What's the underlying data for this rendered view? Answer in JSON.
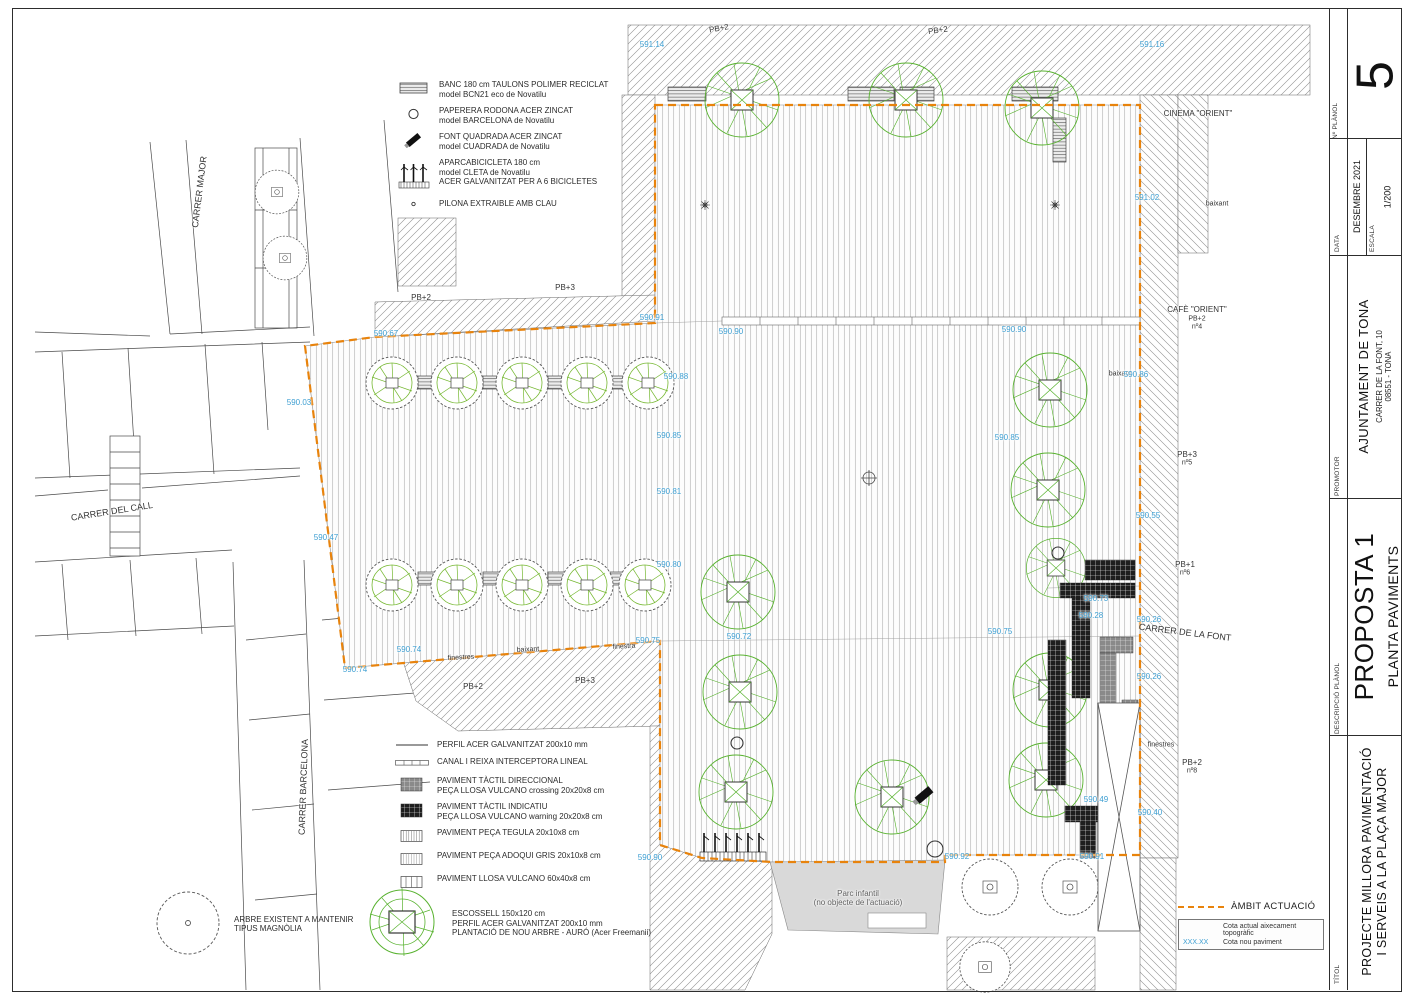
{
  "sheet": {
    "number": "5",
    "number_label": "Nº PLÀNOL",
    "date_label": "DATA",
    "date": "DESEMBRE 2021",
    "scale_label": "ESCALA",
    "scale": "1/200",
    "promoter_label": "PROMOTOR",
    "promoter_name": "AJUNTAMENT DE TONA",
    "promoter_address1": "CARRER DE LA FONT, 10",
    "promoter_address2": "08551  -  TONA",
    "description_label": "DESCRIPCIÓ PLÀNOL",
    "proposal": "PROPOSTA 1",
    "plan_name": "PLANTA PAVIMENTS",
    "title_label": "TÍTOL",
    "project_title1": "PROJECTE MILLORA PAVIMENTACIÓ",
    "project_title2": "I SERVEIS A LA PLAÇA MAJOR"
  },
  "legend_furniture": [
    {
      "symbol": "bench",
      "lines": [
        "BANC 180 cm TAULONS POLIMER RECICLAT",
        "model BCN21 eco de Novatilu"
      ]
    },
    {
      "symbol": "bin",
      "lines": [
        "PAPERERA RODONA ACER ZINCAT",
        "model BARCELONA de Novatilu"
      ]
    },
    {
      "symbol": "fountain",
      "lines": [
        "FONT QUADRADA ACER ZINCAT",
        "model CUADRADA de Novatilu"
      ]
    },
    {
      "symbol": "bike-rack",
      "lines": [
        "APARCABICICLETA 180 cm",
        "model CLETA de Novatilu",
        "ACER GALVANITZAT PER A 6 BICICLETES"
      ]
    },
    {
      "symbol": "bollard",
      "lines": [
        "PILONA EXTRAIBLE AMB CLAU"
      ]
    }
  ],
  "legend_paving": [
    {
      "symbol": "steel-line",
      "lines": [
        "PERFIL ACER GALVANITZAT 200x10 mm"
      ]
    },
    {
      "symbol": "channel",
      "lines": [
        "CANAL I REIXA INTERCEPTORA LINEAL"
      ]
    },
    {
      "symbol": "tactile-directional",
      "lines": [
        "PAVIMENT TÀCTIL DIRECCIONAL",
        "PEÇA LLOSA VULCANO crossing 20x20x8 cm"
      ]
    },
    {
      "symbol": "tactile-warning",
      "lines": [
        "PAVIMENT TÀCTIL INDICATIU",
        "PEÇA LLOSA VULCANO warning 20x20x8 cm"
      ]
    },
    {
      "symbol": "tegula",
      "lines": [
        "PAVIMENT PEÇA TEGULA 20x10x8 cm"
      ]
    },
    {
      "symbol": "adoqui",
      "lines": [
        "PAVIMENT PEÇA ADOQUI GRIS 20x10x8 cm"
      ]
    },
    {
      "symbol": "llosa",
      "lines": [
        "PAVIMENT LLOSA VULCANO 60x40x8 cm"
      ]
    }
  ],
  "legend_trees": [
    {
      "symbol": "existing-tree",
      "lines": [
        "ARBRE EXISTENT A MANTENIR",
        "TIPUS MAGNÒLIA"
      ]
    },
    {
      "symbol": "new-tree",
      "lines": [
        "ESCOSSELL 150x120 cm",
        "PERFIL ACER GALVANITZAT 200x10 mm",
        "PLANTACIÓ DE NOU ARBRE - AURÓ (Acer Freemanii)"
      ]
    }
  ],
  "scope": {
    "label": "ÀMBIT ACTUACIÓ",
    "cota_actual": "Cota actual aixecament topogràfic",
    "cota_value": "XXX.XX",
    "cota_nova": "Cota nou paviment"
  },
  "colors": {
    "scope_orange": "#e8830c",
    "elevation_blue": "#3e9fd2",
    "tree_green": "#58b22f"
  },
  "plan_labels": [
    {
      "t": "CARRER MAJOR",
      "x": 200,
      "y": 192,
      "r": -83,
      "c": "k",
      "s": 9
    },
    {
      "t": "CARRER DEL CALL",
      "x": 112,
      "y": 512,
      "r": -9,
      "c": "k",
      "s": 9
    },
    {
      "t": "CARRER BARCELONA",
      "x": 304,
      "y": 787,
      "r": -88,
      "c": "k",
      "s": 9
    },
    {
      "t": "CARRER DE LA FONT",
      "x": 1185,
      "y": 633,
      "r": 7,
      "c": "k",
      "s": 9
    },
    {
      "t": "CINEMA \"ORIENT\"",
      "x": 1198,
      "y": 114,
      "r": 0,
      "c": "k",
      "s": 8
    },
    {
      "t": "CAFÈ \"ORIENT\"",
      "x": 1197,
      "y": 310,
      "r": 0,
      "c": "k",
      "s": 8
    },
    {
      "t": "PB+2",
      "x": 1197,
      "y": 319,
      "r": 0,
      "c": "k",
      "s": 7
    },
    {
      "t": "nº4",
      "x": 1197,
      "y": 327,
      "r": 0,
      "c": "k",
      "s": 7
    },
    {
      "t": "PB+3",
      "x": 1187,
      "y": 455,
      "r": 0,
      "c": "k",
      "s": 8
    },
    {
      "t": "nº5",
      "x": 1187,
      "y": 463,
      "r": 0,
      "c": "k",
      "s": 7
    },
    {
      "t": "PB+1",
      "x": 1185,
      "y": 565,
      "r": 0,
      "c": "k",
      "s": 8
    },
    {
      "t": "nº6",
      "x": 1185,
      "y": 573,
      "r": 0,
      "c": "k",
      "s": 7
    },
    {
      "t": "PB+2",
      "x": 1192,
      "y": 763,
      "r": 0,
      "c": "k",
      "s": 8
    },
    {
      "t": "nº8",
      "x": 1192,
      "y": 771,
      "r": 0,
      "c": "k",
      "s": 7
    },
    {
      "t": "PB+2",
      "x": 719,
      "y": 29,
      "r": -10,
      "c": "k",
      "s": 8
    },
    {
      "t": "PB+2",
      "x": 938,
      "y": 31,
      "r": -8,
      "c": "k",
      "s": 8
    },
    {
      "t": "PB+2",
      "x": 421,
      "y": 298,
      "r": 0,
      "c": "k",
      "s": 8
    },
    {
      "t": "PB+3",
      "x": 565,
      "y": 288,
      "r": 0,
      "c": "k",
      "s": 8
    },
    {
      "t": "PB+2",
      "x": 473,
      "y": 687,
      "r": 0,
      "c": "k",
      "s": 8
    },
    {
      "t": "PB+3",
      "x": 585,
      "y": 681,
      "r": 0,
      "c": "k",
      "s": 8
    },
    {
      "t": "finestres",
      "x": 461,
      "y": 658,
      "r": -3,
      "c": "k",
      "s": 7
    },
    {
      "t": "baixant",
      "x": 528,
      "y": 650,
      "r": -3,
      "c": "k",
      "s": 7
    },
    {
      "t": "finestra",
      "x": 624,
      "y": 647,
      "r": -3,
      "c": "k",
      "s": 7
    },
    {
      "t": "baixant",
      "x": 1217,
      "y": 204,
      "r": 0,
      "c": "k",
      "s": 7
    },
    {
      "t": "baixant",
      "x": 1120,
      "y": 374,
      "r": 0,
      "c": "k",
      "s": 7
    },
    {
      "t": "finestres",
      "x": 1161,
      "y": 745,
      "r": 0,
      "c": "k",
      "s": 7
    },
    {
      "t": "Parc infantil",
      "x": 858,
      "y": 894,
      "r": 0,
      "c": "g",
      "s": 8
    },
    {
      "t": "(no objecte de l'actuació)",
      "x": 858,
      "y": 903,
      "r": 0,
      "c": "g",
      "s": 8
    },
    {
      "t": "591.14",
      "x": 652,
      "y": 45,
      "r": 0,
      "c": "b",
      "s": 8
    },
    {
      "t": "591.16",
      "x": 1152,
      "y": 45,
      "r": 0,
      "c": "b",
      "s": 8
    },
    {
      "t": "591.02",
      "x": 1147,
      "y": 198,
      "r": 0,
      "c": "b",
      "s": 8
    },
    {
      "t": "590.03",
      "x": 299,
      "y": 403,
      "r": 0,
      "c": "b",
      "s": 8
    },
    {
      "t": "590.47",
      "x": 326,
      "y": 538,
      "r": 0,
      "c": "b",
      "s": 8
    },
    {
      "t": "590.67",
      "x": 386,
      "y": 334,
      "r": 0,
      "c": "b",
      "s": 8
    },
    {
      "t": "590.91",
      "x": 652,
      "y": 318,
      "r": 0,
      "c": "b",
      "s": 8
    },
    {
      "t": "590.90",
      "x": 731,
      "y": 332,
      "r": 0,
      "c": "b",
      "s": 8
    },
    {
      "t": "590.90",
      "x": 1014,
      "y": 330,
      "r": 0,
      "c": "b",
      "s": 8
    },
    {
      "t": "590.88",
      "x": 676,
      "y": 377,
      "r": 0,
      "c": "b",
      "s": 8
    },
    {
      "t": "590.85",
      "x": 669,
      "y": 436,
      "r": 0,
      "c": "b",
      "s": 8
    },
    {
      "t": "590.81",
      "x": 669,
      "y": 492,
      "r": 0,
      "c": "b",
      "s": 8
    },
    {
      "t": "590.80",
      "x": 669,
      "y": 565,
      "r": 0,
      "c": "b",
      "s": 8
    },
    {
      "t": "590.85",
      "x": 1007,
      "y": 438,
      "r": 0,
      "c": "b",
      "s": 8
    },
    {
      "t": "590.86",
      "x": 1136,
      "y": 375,
      "r": 0,
      "c": "b",
      "s": 8
    },
    {
      "t": "590.55",
      "x": 1148,
      "y": 516,
      "r": 0,
      "c": "b",
      "s": 8
    },
    {
      "t": "590.73",
      "x": 1096,
      "y": 599,
      "r": 0,
      "c": "b",
      "s": 8
    },
    {
      "t": "590.28",
      "x": 1091,
      "y": 616,
      "r": 0,
      "c": "b",
      "s": 8
    },
    {
      "t": "590.26",
      "x": 1149,
      "y": 620,
      "r": 0,
      "c": "b",
      "s": 8
    },
    {
      "t": "590.26",
      "x": 1149,
      "y": 677,
      "r": 0,
      "c": "b",
      "s": 8
    },
    {
      "t": "590.72",
      "x": 739,
      "y": 637,
      "r": 0,
      "c": "b",
      "s": 8
    },
    {
      "t": "590.75",
      "x": 1000,
      "y": 632,
      "r": 0,
      "c": "b",
      "s": 8
    },
    {
      "t": "590.74",
      "x": 355,
      "y": 670,
      "r": 0,
      "c": "b",
      "s": 8
    },
    {
      "t": "590.74",
      "x": 409,
      "y": 650,
      "r": 0,
      "c": "b",
      "s": 8
    },
    {
      "t": "590.75",
      "x": 648,
      "y": 641,
      "r": 0,
      "c": "b",
      "s": 8
    },
    {
      "t": "590.49",
      "x": 1096,
      "y": 800,
      "r": 0,
      "c": "b",
      "s": 8
    },
    {
      "t": "590.40",
      "x": 1150,
      "y": 813,
      "r": 0,
      "c": "b",
      "s": 8
    },
    {
      "t": "590.90",
      "x": 650,
      "y": 858,
      "r": 0,
      "c": "b",
      "s": 8
    },
    {
      "t": "590.92",
      "x": 957,
      "y": 857,
      "r": 0,
      "c": "b",
      "s": 8
    },
    {
      "t": "590.91",
      "x": 1092,
      "y": 857,
      "r": 0,
      "c": "b",
      "s": 8
    }
  ]
}
